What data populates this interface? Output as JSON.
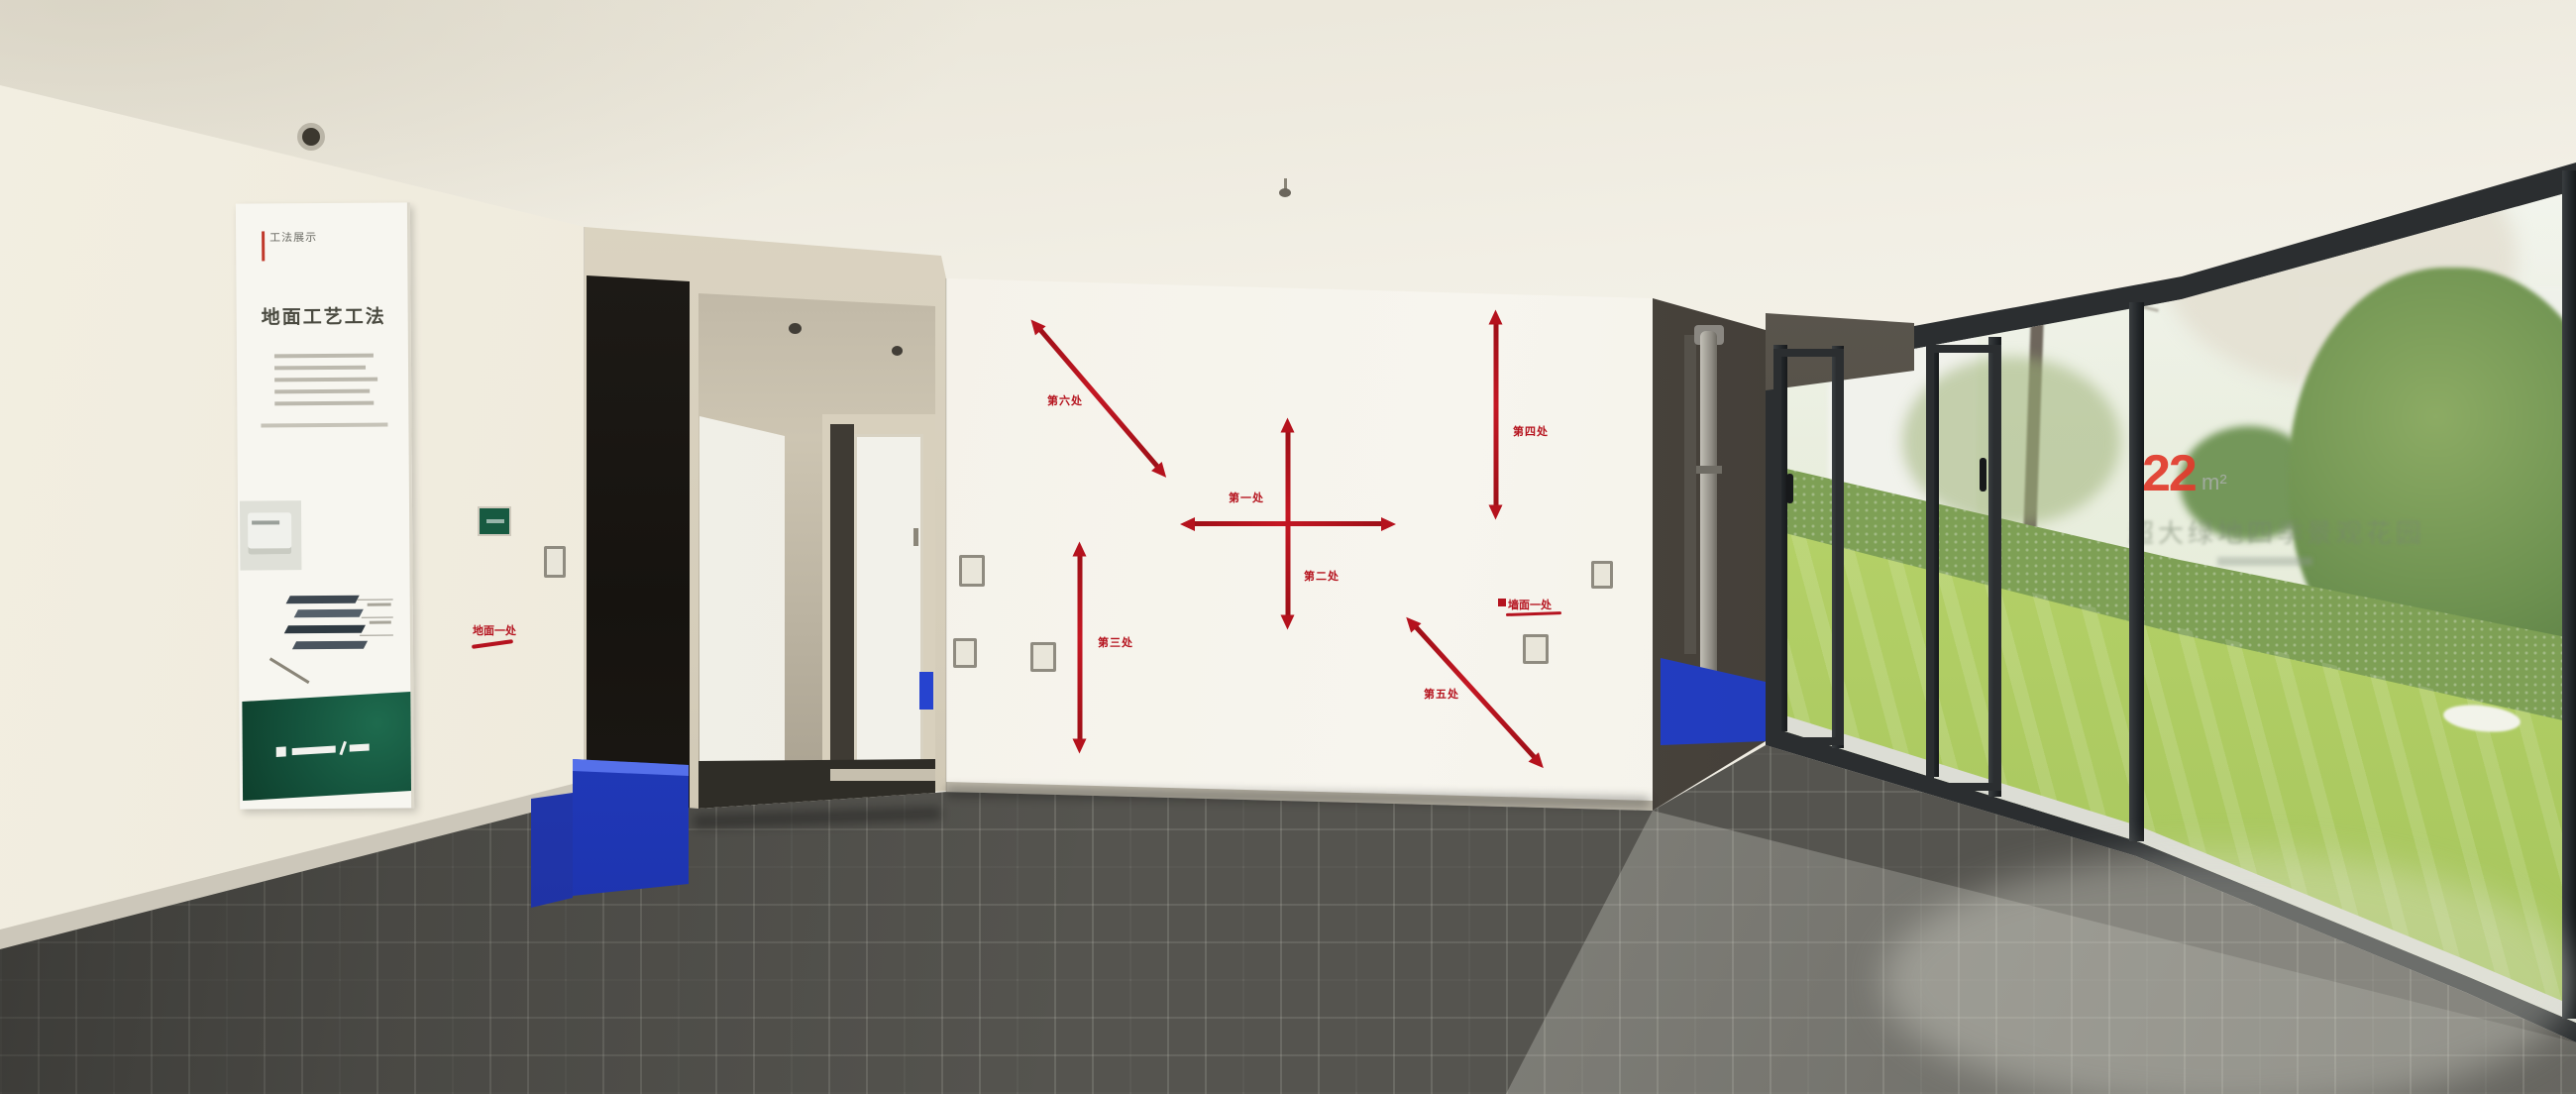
{
  "scene": {
    "description": "Show-flat interior panorama: craft-demo wall with red measurement arrows, process poster on left wall, floor-to-ceiling windows onto a garden lawn at right"
  },
  "poster": {
    "logo_mark": "工法展示",
    "title": "地面工艺工法"
  },
  "left_wall": {
    "red_note": "地面一处"
  },
  "demo_wall": {
    "spots": [
      {
        "label": "第一处"
      },
      {
        "label": "第二处"
      },
      {
        "label": "第三处"
      },
      {
        "label": "第四处"
      },
      {
        "label": "第五处"
      },
      {
        "label": "第六处"
      }
    ],
    "boxed_note": "墙面一处"
  },
  "window": {
    "area_number": "22",
    "area_unit": "m²",
    "caption": "超大绿地四季景观花园"
  },
  "colors": {
    "arrow_red": "#b5121d",
    "accent_blue": "#2743cd",
    "poster_green": "#14523c",
    "decal_red": "#e23a2c",
    "carpet_dark": "#55544f",
    "lawn_green": "#b5d168"
  }
}
